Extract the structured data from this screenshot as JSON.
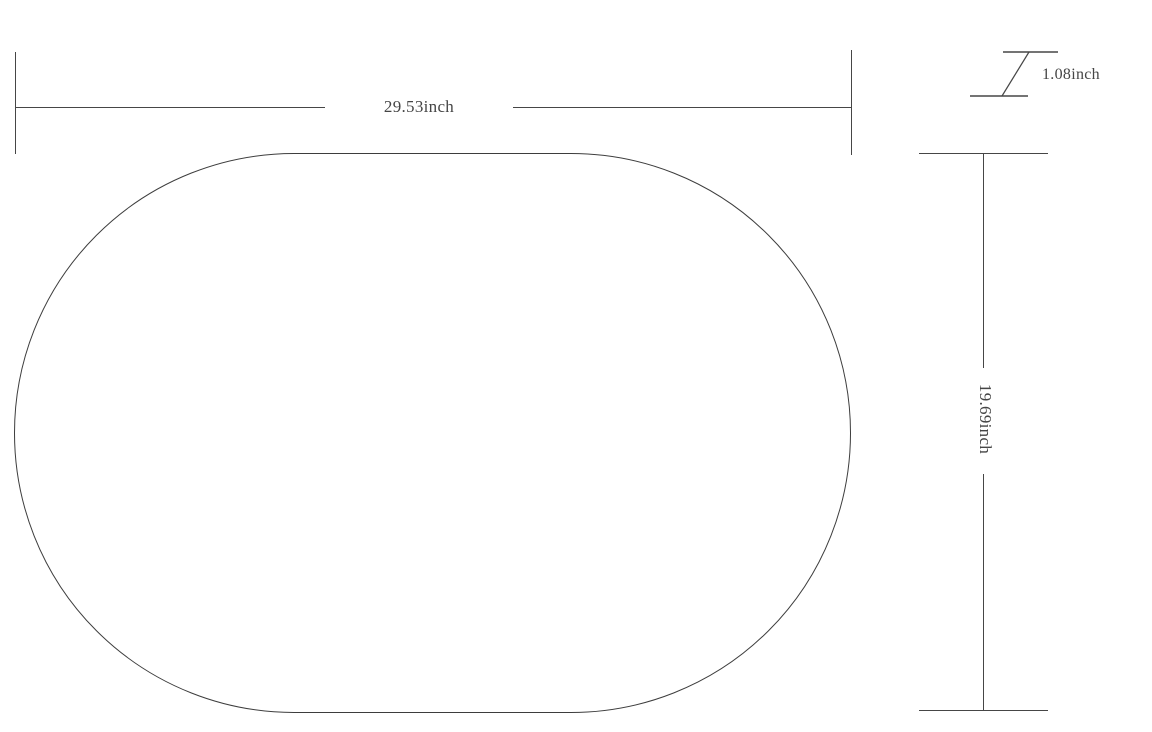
{
  "figure": {
    "type": "product-dimension-drawing",
    "subject": "oval rug outline",
    "width_dimension": {
      "label": "29.53inch"
    },
    "height_dimension": {
      "label": "19.69inch"
    },
    "thickness_dimension": {
      "label": "1.08inch"
    }
  },
  "colors": {
    "line": "#464646",
    "outline": "#3d3d3d",
    "text": "#454545",
    "background": "#ffffff"
  }
}
